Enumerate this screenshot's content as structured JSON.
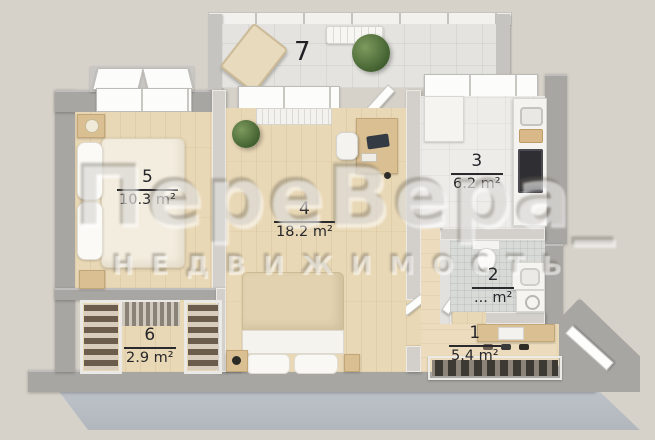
{
  "plan": {
    "rooms": {
      "r7": {
        "number": "7",
        "area": ""
      },
      "r5": {
        "number": "5",
        "area": "10.3 m²"
      },
      "r4": {
        "number": "4",
        "area": "18.2 m²"
      },
      "r3": {
        "number": "3",
        "area": "6.2 m²"
      },
      "r2": {
        "number": "2",
        "area": "... m²"
      },
      "r6": {
        "number": "6",
        "area": "2.9 m²"
      },
      "r1": {
        "number": "1",
        "area": "5.4 m²"
      }
    }
  },
  "watermark": {
    "brand": "ПереВера_",
    "subtitle": "НЕДВИЖИМОСТЬ"
  },
  "colors": {
    "background": "#d6d2ca",
    "outer_wall": "#a8a6a2",
    "partition_wall": "#d3d0cb",
    "wood_floor": "#e9d8b5",
    "balcony_tile": "#e4e3df",
    "bathroom_tile": "#d8dad8",
    "label_text": "#26262a",
    "foundation_slab": "#b9bec4"
  }
}
